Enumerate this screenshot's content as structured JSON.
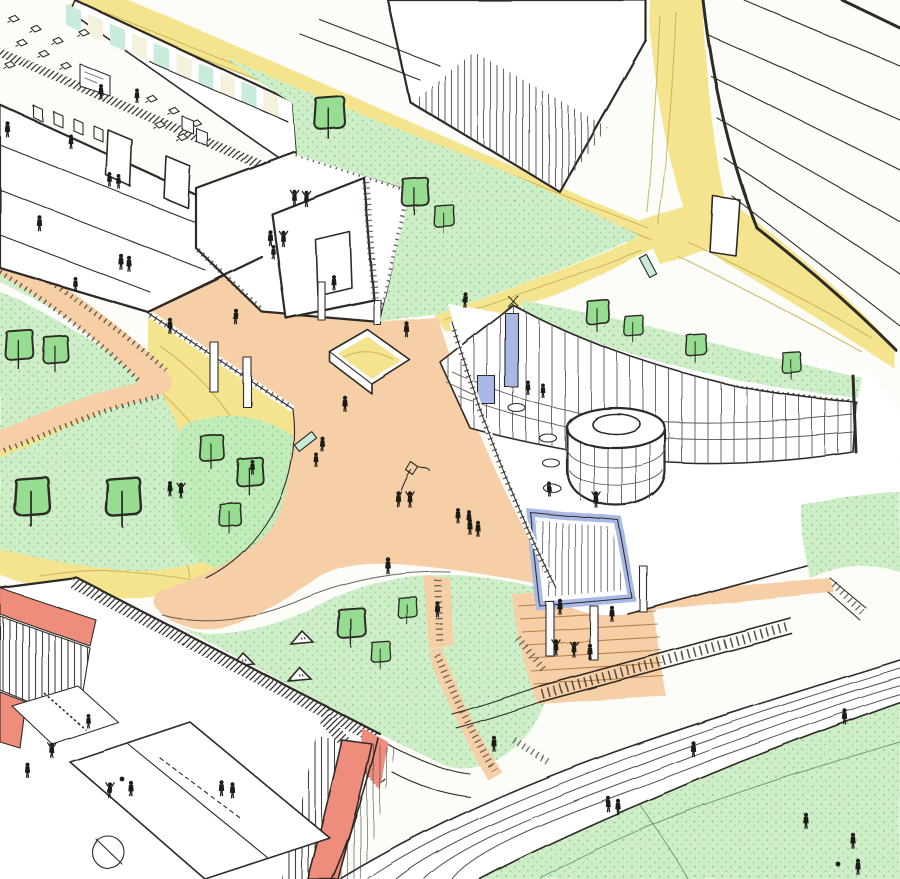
{
  "scene": {
    "type": "hand-drawn axonometric architectural illustration",
    "description": "Colored pencil-and-ink axonometric sketch of a school campus: a cut-open classroom building, a curved pavilion with cylindrical hall and roof garden, yellow winding paths, orange plazas with a sunken sandpit and amphitheater, garden terraces, a red sports building with rooftop basketball court, a grand staircase, a running track and a green sports field, populated with tiny human figures.",
    "elements": [
      {
        "name": "main-school-building",
        "label": "multi-storey school block with cut-away classroom floor"
      },
      {
        "name": "classroom-interior",
        "label": "exposed classroom with desks, whiteboard and glass partitions"
      },
      {
        "name": "rooftop-terrace",
        "label": "roof terrace with parapet and dancing figures"
      },
      {
        "name": "tower-block",
        "label": "attached stair/room block with window"
      },
      {
        "name": "pilotis",
        "label": "building raised on slender columns over the plaza"
      },
      {
        "name": "neighbor-building-north",
        "label": "white roof volume with striped facade"
      },
      {
        "name": "neighbor-building-east",
        "label": "large white facade with diagonal floor lines"
      },
      {
        "name": "yellow-paths",
        "label": "winding yellow pedestrian paths with contour lines and junction"
      },
      {
        "name": "switchback-ramp",
        "label": "yellow ramp looping around a planted mound"
      },
      {
        "name": "fenced-walkway",
        "label": "orange fenced walkway between garden terraces"
      },
      {
        "name": "garden-terraces",
        "label": "green lawns with trees on the left"
      },
      {
        "name": "central-plaza",
        "label": "orange plaza with sunken yellow sandpit"
      },
      {
        "name": "kite-flyers",
        "label": "two children flying a kite on the plaza"
      },
      {
        "name": "curved-pavilion",
        "label": "Y-shaped pavilion with gridded curtain wall"
      },
      {
        "name": "pavilion-drum",
        "label": "two-tier cylindrical hall"
      },
      {
        "name": "pavilion-green-roof",
        "label": "roof garden band with small trees"
      },
      {
        "name": "blue-window",
        "label": "blue framed glazed opening under the pavilion"
      },
      {
        "name": "cafe-terrace",
        "label": "round tables with seated figures"
      },
      {
        "name": "amphitheater",
        "label": "orange terraced steps with dancing figures"
      },
      {
        "name": "grand-staircase",
        "label": "long diagonal stair to the lower field"
      },
      {
        "name": "sports-building",
        "label": "red-framed building with glazed strips"
      },
      {
        "name": "basketball-court",
        "label": "rooftop basketball court with players"
      },
      {
        "name": "volleyball-court",
        "label": "small court with net"
      },
      {
        "name": "playground-slope",
        "label": "green slope with triangular play tents"
      },
      {
        "name": "running-track",
        "label": "curved white track with lane lines"
      },
      {
        "name": "sports-field",
        "label": "large green field with players and ball"
      }
    ],
    "stats": {
      "people_count": 58,
      "tree_count": 17,
      "play_tent_count": 3,
      "cafe_table_count": 4,
      "desk_count": 13,
      "bench_count": 2,
      "track_lane_line_count": 6,
      "amphitheater_terrace_count": 7
    }
  },
  "palette": {
    "paper": "#fcfcf9",
    "ink": "#2e2b28",
    "path_yellow": "#f4e48e",
    "path_line": "#c9ae57",
    "lawn": "#cdeec6",
    "lawn_dot": "#55a163",
    "mound_green": "#c2ecba",
    "tree_green": "#96dd92",
    "plaza_orange": "#f6cfa6",
    "glass_teal": "#c8ecd9",
    "glass_cream": "#f4f1dd",
    "accent_blue": "#a9b9e6",
    "building_red": "#ef8d7c",
    "figure_black": "#1b1a19"
  }
}
